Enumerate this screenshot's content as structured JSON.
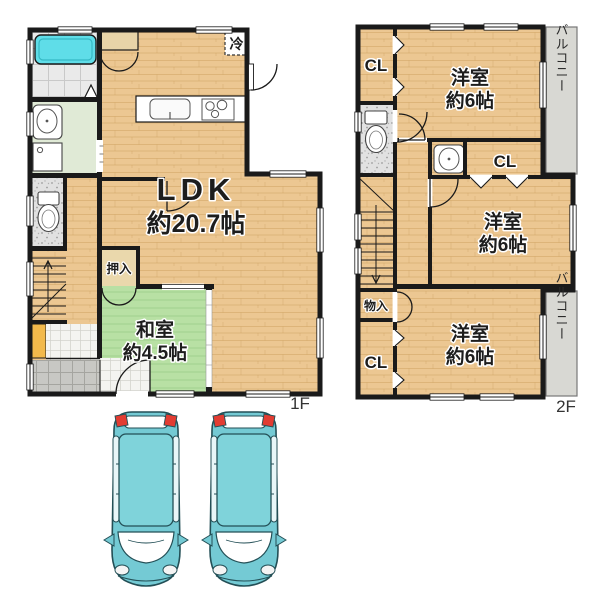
{
  "floor1": {
    "floor_label": "1F",
    "ldk_name": "LDK",
    "ldk_size": "約20.7帖",
    "washitsu_name": "和室",
    "washitsu_size": "約4.5帖",
    "oshiire": "押入",
    "refrigerator": "冷"
  },
  "floor2": {
    "floor_label": "2F",
    "room_top_name": "洋室",
    "room_top_size": "約6帖",
    "room_mid_name": "洋室",
    "room_mid_size": "約6帖",
    "room_bottom_name": "洋室",
    "room_bottom_size": "約6帖",
    "closet_top": "CL",
    "closet_mid": "CL",
    "closet_bottom": "CL",
    "storage": "物入",
    "balcony_top": "バルコニー",
    "balcony_bottom": "バルコニー"
  },
  "colors": {
    "wall": "#1a1a1a",
    "wood": "#ecc792",
    "tatami": "#b8e0a4",
    "bathtub": "#5fdde8",
    "balcony": "#d8d8d3",
    "shoe_cabinet": "#f2b94b",
    "car_body": "#74cad4"
  }
}
